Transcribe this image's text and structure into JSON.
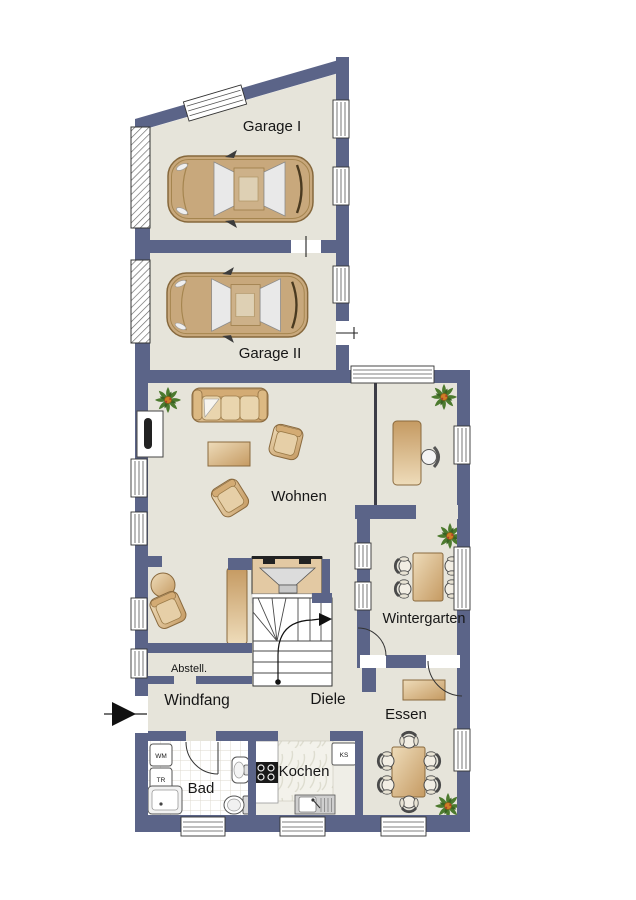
{
  "title": "Erdgeschoss Grundriss",
  "labels": {
    "garage1": "Garage I",
    "garage2": "Garage II",
    "wohnen": "Wohnen",
    "wintergarten": "Wintergarten",
    "essen": "Essen",
    "kochen": "Kochen",
    "bad": "Bad",
    "windfang": "Windfang",
    "diele": "Diele",
    "abstell": "Abstell.",
    "wm": "WM",
    "tr": "TR",
    "ks": "KS"
  },
  "colors": {
    "wall": "#5b6488",
    "floor": "#e6e4da",
    "wood_light": "#eedcba",
    "wood_dark": "#c59a62",
    "background": "#ffffff"
  }
}
